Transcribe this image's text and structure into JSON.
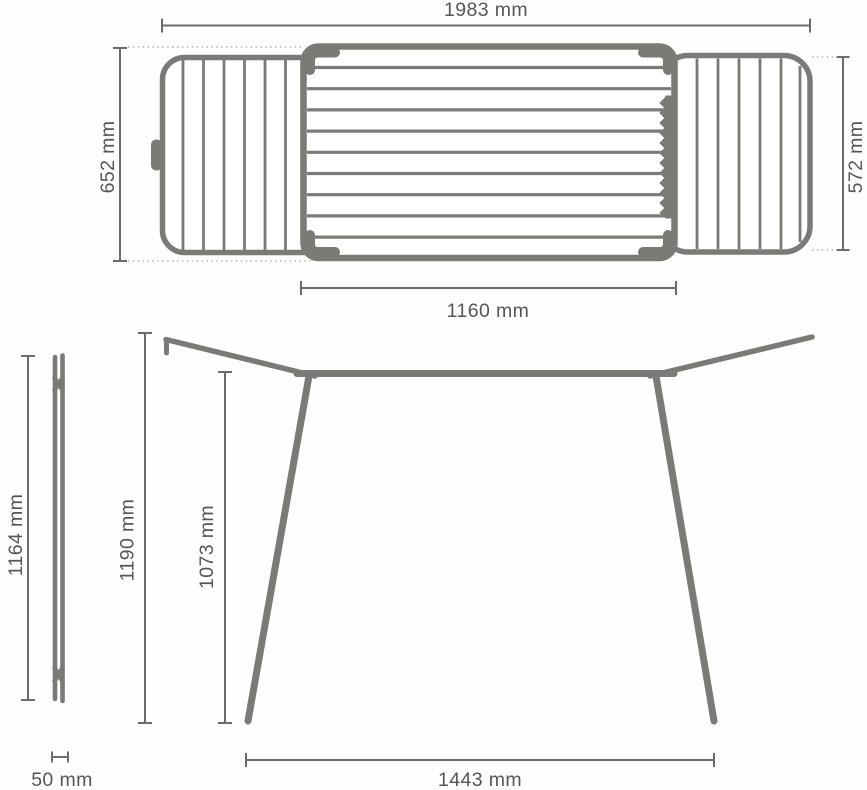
{
  "title": "Folding clothes drying rack — dimension diagram",
  "colors": {
    "background": "#fefefe",
    "frame": "#7a7a77",
    "dimension": "#6b6c6e",
    "leader": "#b4b4b2",
    "text": "#55565a"
  },
  "views": {
    "top": {
      "label": "top view (open rack with two wings)",
      "dims": {
        "total_width": "1983 mm",
        "center_depth": "652 mm",
        "wing_depth": "572 mm",
        "center_width": "1160 mm"
      }
    },
    "side": {
      "label": "side view (folded flat)",
      "dims": {
        "folded_height": "1164 mm",
        "folded_depth": "50 mm"
      }
    },
    "front": {
      "label": "front view (standing)",
      "dims": {
        "overall_height": "1190 mm",
        "rail_height": "1073 mm",
        "leg_span": "1443 mm"
      }
    }
  }
}
